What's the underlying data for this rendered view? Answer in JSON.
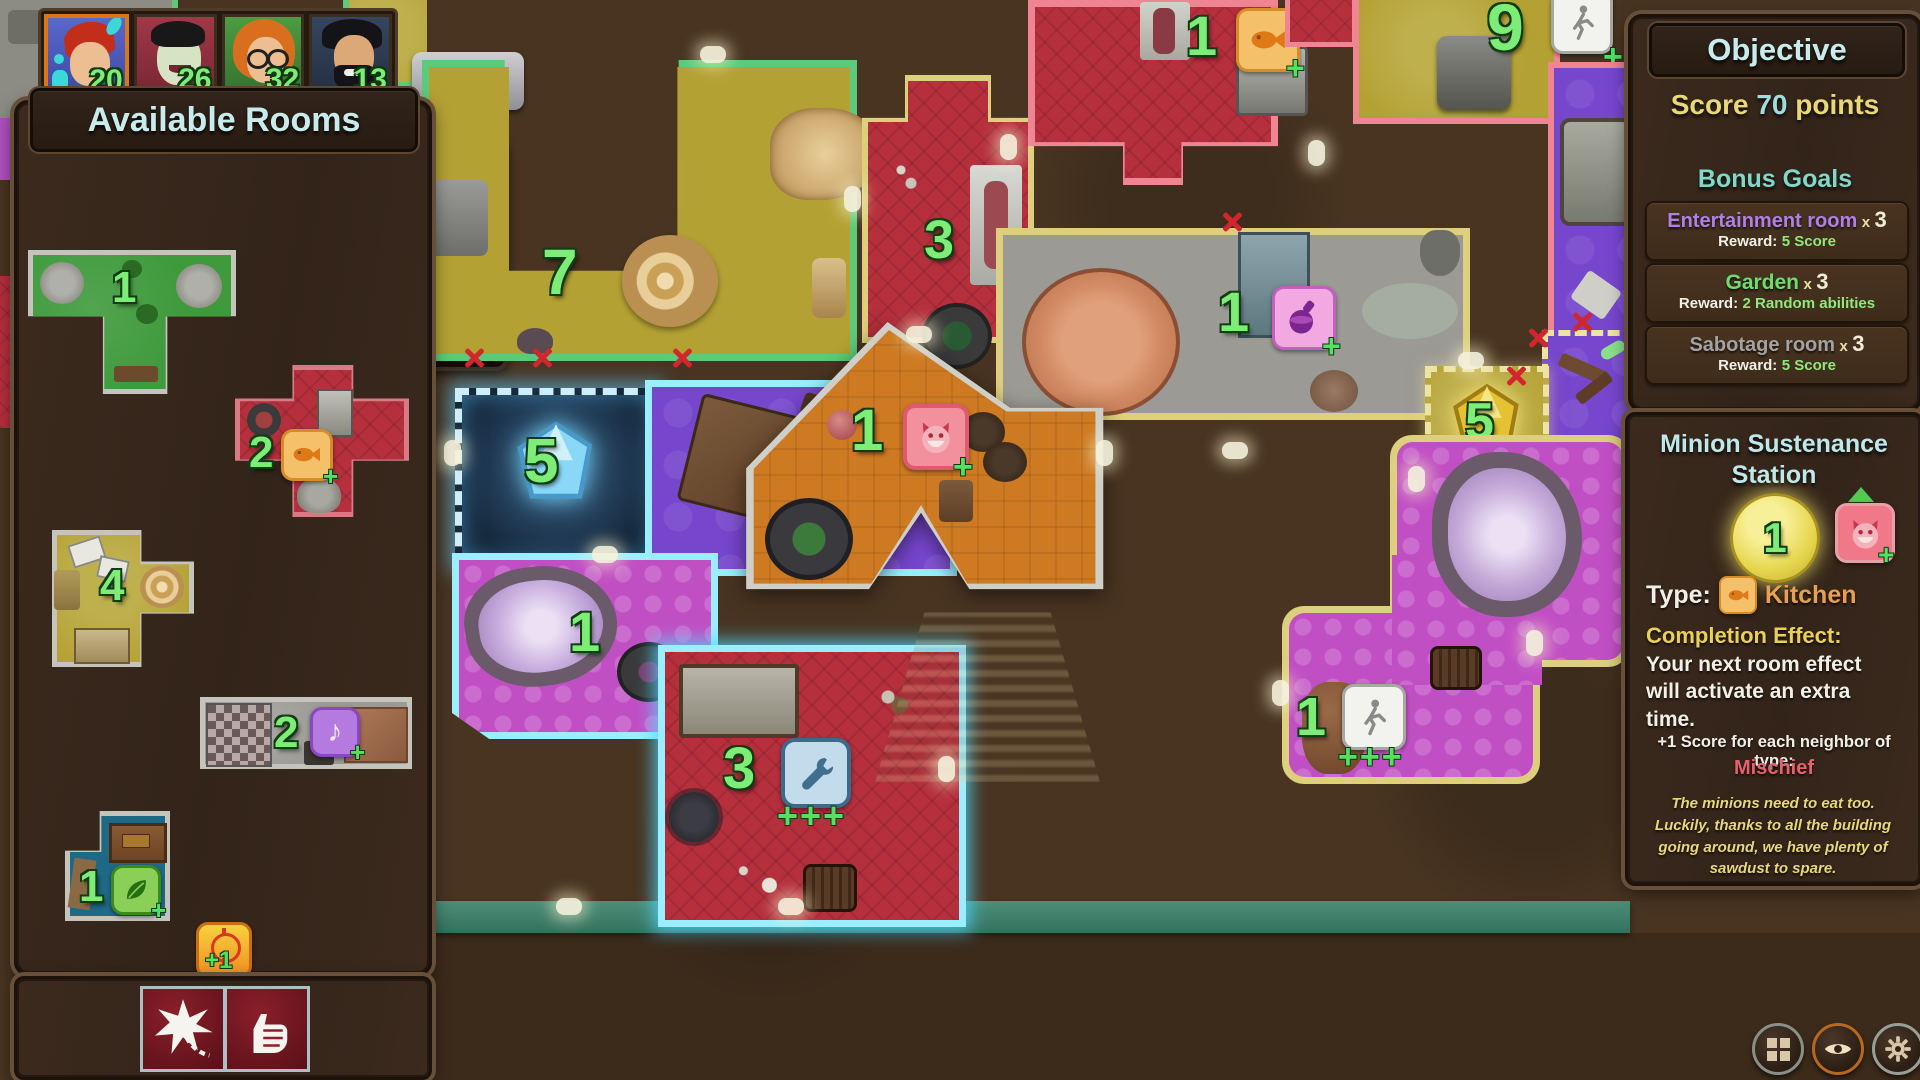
{
  "hud": {
    "portraits": [
      {
        "player": "player-1",
        "score": "20"
      },
      {
        "player": "player-2",
        "score": "26"
      },
      {
        "player": "player-3",
        "score": "32"
      },
      {
        "player": "player-4",
        "score": "13"
      }
    ]
  },
  "available_rooms": {
    "title": "Available Rooms",
    "garden_t": {
      "count": "1"
    },
    "kitchen_cross": {
      "count": "2",
      "plus": "+"
    },
    "gold_l": {
      "count": "4"
    },
    "music_hall": {
      "count": "2",
      "plus": "+"
    },
    "leaf_room": {
      "count": "1",
      "plus": "+"
    },
    "target_bonus": {
      "label": "+1"
    }
  },
  "board": {
    "garden7": {
      "count": "7"
    },
    "butcher3": {
      "count": "3"
    },
    "kitchen1": {
      "count": "1",
      "plus": "+"
    },
    "throne9": {
      "count": "9",
      "plus": "+"
    },
    "potion1": {
      "count": "1",
      "plus": "+"
    },
    "gem5": {
      "count": "5"
    },
    "table3": {
      "count": "3"
    },
    "geode1": {
      "count": "1"
    },
    "workshop3": {
      "count": "3",
      "plus": "+++"
    },
    "station1": {
      "count": "1",
      "plus": "+"
    },
    "gold5": {
      "count": "5"
    },
    "walk1": {
      "count": "1",
      "plus": "+++"
    }
  },
  "objective": {
    "title": "Objective",
    "score_prefix": "Score",
    "score_value": "70",
    "score_suffix": "points",
    "bonus_title": "Bonus Goals",
    "goals": [
      {
        "name": "Entertainment room",
        "mult_x": "x",
        "mult_n": "3",
        "reward_label": "Reward:",
        "reward": "5 Score"
      },
      {
        "name": "Garden",
        "mult_x": "x",
        "mult_n": "3",
        "reward_label": "Reward:",
        "reward": "2 Random abilities"
      },
      {
        "name": "Sabotage room",
        "mult_x": "x",
        "mult_n": "3",
        "reward_label": "Reward:",
        "reward": "5 Score"
      }
    ]
  },
  "station": {
    "title_line1": "Minion Sustenance",
    "title_line2": "Station",
    "count": "1",
    "plus": "+",
    "type_label": "Type:",
    "type_value": "Kitchen",
    "effect_label": "Completion Effect:",
    "effect_text": "Your next room effect will activate an extra time.",
    "neighbor_text": "+1 Score for each neighbor of type:",
    "neighbor_type": "Mischief",
    "flavor": "The minions need to eat too. Luckily, thanks to all the building going around, we have plenty of sawdust to spare."
  },
  "icons": {
    "music_glyph": "♪"
  },
  "colors": {
    "accent_green": "#7ded78",
    "title_cyan": "#c8ecec",
    "goal_purple": "#b07fe8",
    "goal_green": "#6edc6e",
    "goal_gray": "#9a9a9a",
    "reward_green": "#8ee87a",
    "kitchen_orange": "#e8a050",
    "mischief_red": "#e8606e"
  }
}
